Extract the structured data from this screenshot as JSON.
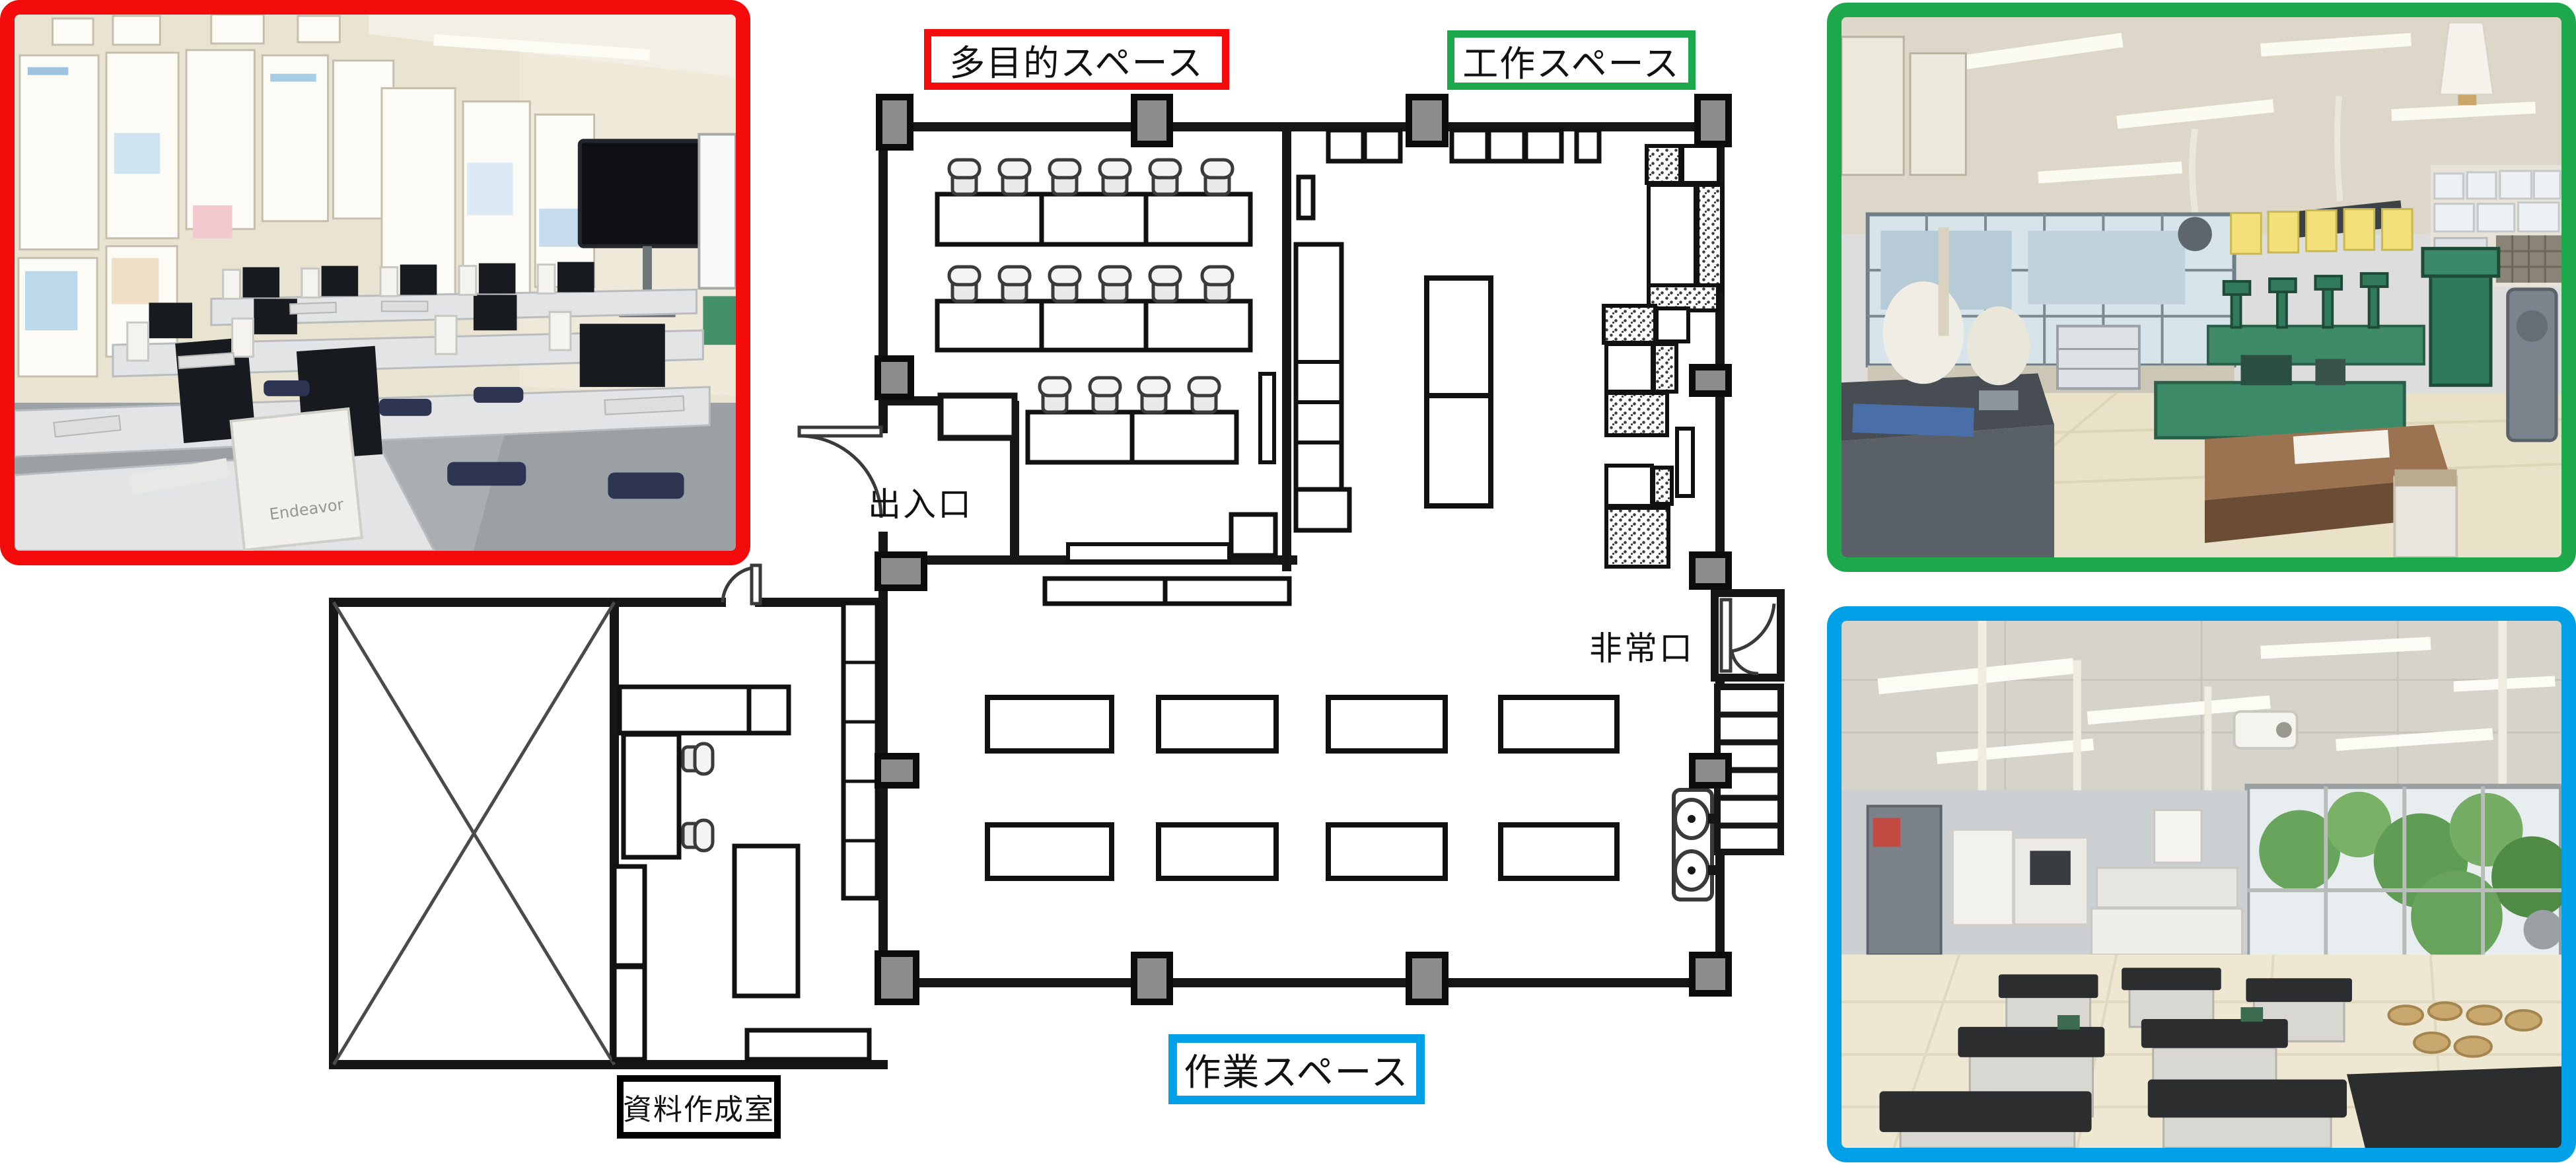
{
  "page": {
    "background": "#ffffff"
  },
  "floor_plan": {
    "labels": {
      "multipurpose": "多目的スペース",
      "craft": "工作スペース",
      "work": "作業スペース",
      "material_room": "資料作成室",
      "entrance": "出入口",
      "emergency_exit": "非常口"
    },
    "colors": {
      "multipurpose_border": "#f40b0b",
      "craft_border": "#1ea84c",
      "work_border": "#00a0e9",
      "material_room_border": "#000000",
      "wall": "#161616",
      "pillar_fill": "#8c8c8c"
    }
  },
  "photos": {
    "computer_room": {
      "border_color": "#f40b0b",
      "pc_label": "Endeavor"
    },
    "craft_room": {
      "border_color": "#1ea84c"
    },
    "work_room": {
      "border_color": "#00a0e9"
    }
  }
}
